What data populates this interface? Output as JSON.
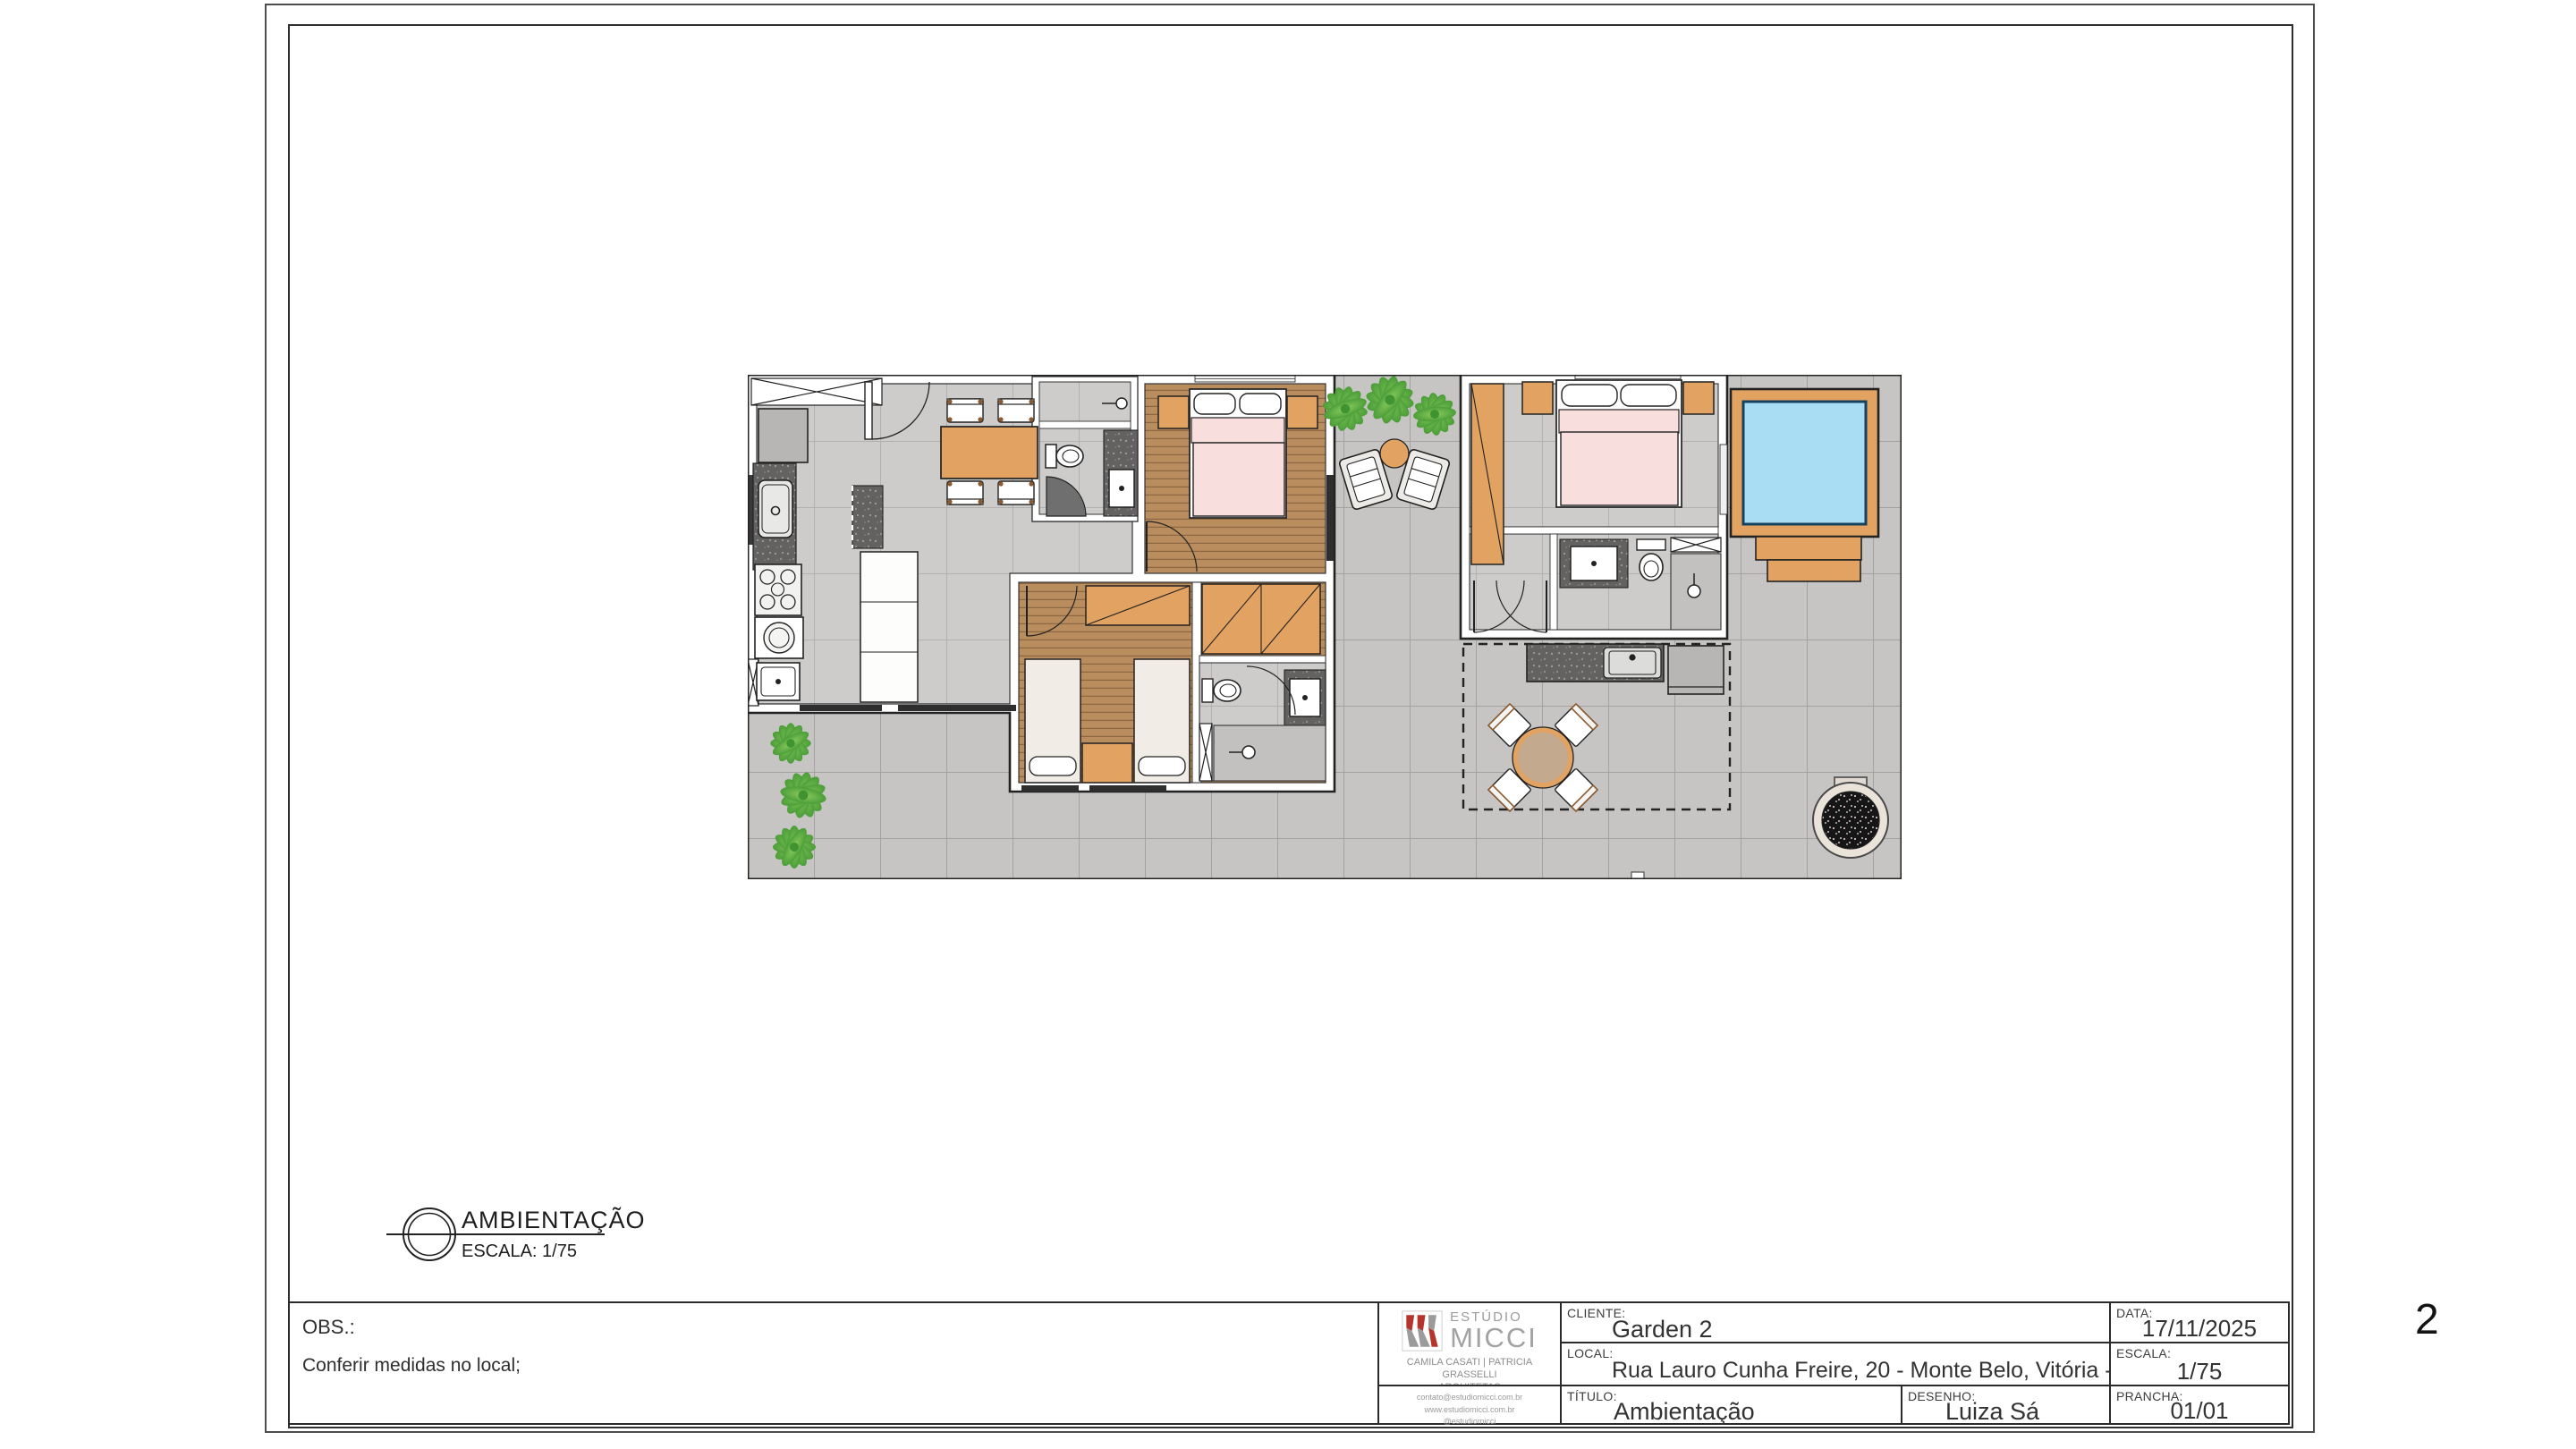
{
  "page": {
    "number": "2"
  },
  "drawing_label": {
    "title": "AMBIENTAÇÃO",
    "scale": "ESCALA: 1/75"
  },
  "obs": {
    "label": "OBS.:",
    "note": "Conferir medidas no local;"
  },
  "title_block": {
    "logo": {
      "line1": "ESTÚDIO",
      "line2": "MICCI",
      "byline1": "CAMILA CASATI | PATRICIA GRASSELLI",
      "byline2": "ARQUITETAS",
      "email": "contato@estudiomicci.com.br",
      "site": "www.estudiomicci.com.br",
      "social": "@estudiomicci"
    },
    "cliente_label": "CLIENTE:",
    "cliente": "Garden 2",
    "local_label": "LOCAL:",
    "local": "Rua Lauro Cunha Freire, 20 - Monte Belo, Vitória - ES",
    "titulo_label": "TÍTULO:",
    "titulo": "Ambientação",
    "desenho_label": "DESENHO:",
    "desenho": "Luiza Sá",
    "data_label": "DATA:",
    "data": "17/11/2025",
    "escala_label": "ESCALA:",
    "escala": "1/75",
    "prancha_label": "PRANCHA:",
    "prancha": "01/01"
  },
  "colors": {
    "accent_red": "#b5342c",
    "logo_gray": "#9b9b9b",
    "tile_floor": "#c6c5c3",
    "tile_grout": "#a3a2a0",
    "interior_tile": "#cdccca",
    "interior_grout": "#b2b1af",
    "wood_floor": "#ba8d5f",
    "wood_line": "#8d6740",
    "furniture_wood": "#e2a262",
    "furniture_wood_dark": "#8a5a30",
    "bed_pink": "#f9dede",
    "bed_ivory": "#f1ede6",
    "pool_water": "#a9ddf4",
    "pool_border": "#14425e",
    "counter_dark": "#636260",
    "cabinet_gray": "#b7b6b4",
    "shower_tile": "#c2c1bf",
    "plant_dark": "#3f9431",
    "plant_light": "#8ccd5e",
    "planter_ring": "#e9e3da",
    "wall_line": "#222222"
  }
}
